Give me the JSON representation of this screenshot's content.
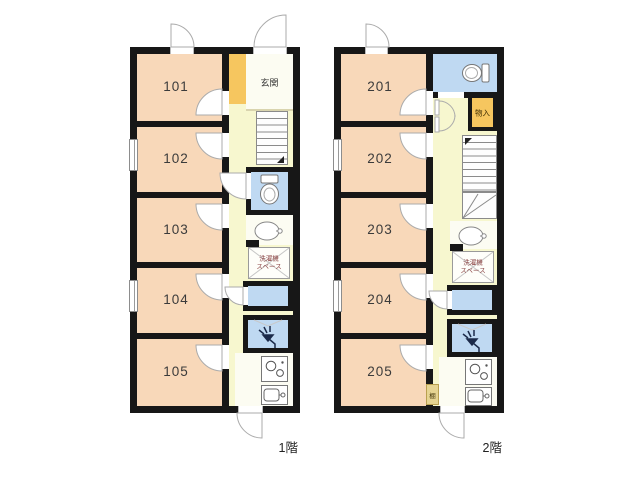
{
  "palette": {
    "wall": "#171717",
    "room": "#F8D8B9",
    "corridor": "#F7F7CF",
    "paper": "#FCFCF2",
    "water": "#BFD9F2",
    "accent": "#F6C65F",
    "shelf": "#E6D492",
    "laundry_text": "#8B4444"
  },
  "floors": [
    {
      "label": "1階",
      "rooms": [
        "101",
        "102",
        "103",
        "104",
        "105"
      ],
      "entrance": "玄関",
      "laundry_top": "洗濯機",
      "laundry_bottom": "スペース"
    },
    {
      "label": "2階",
      "rooms": [
        "201",
        "202",
        "203",
        "204",
        "205"
      ],
      "storage": "物入",
      "shelf": "棚",
      "laundry_top": "洗濯機",
      "laundry_bottom": "スペース"
    }
  ]
}
